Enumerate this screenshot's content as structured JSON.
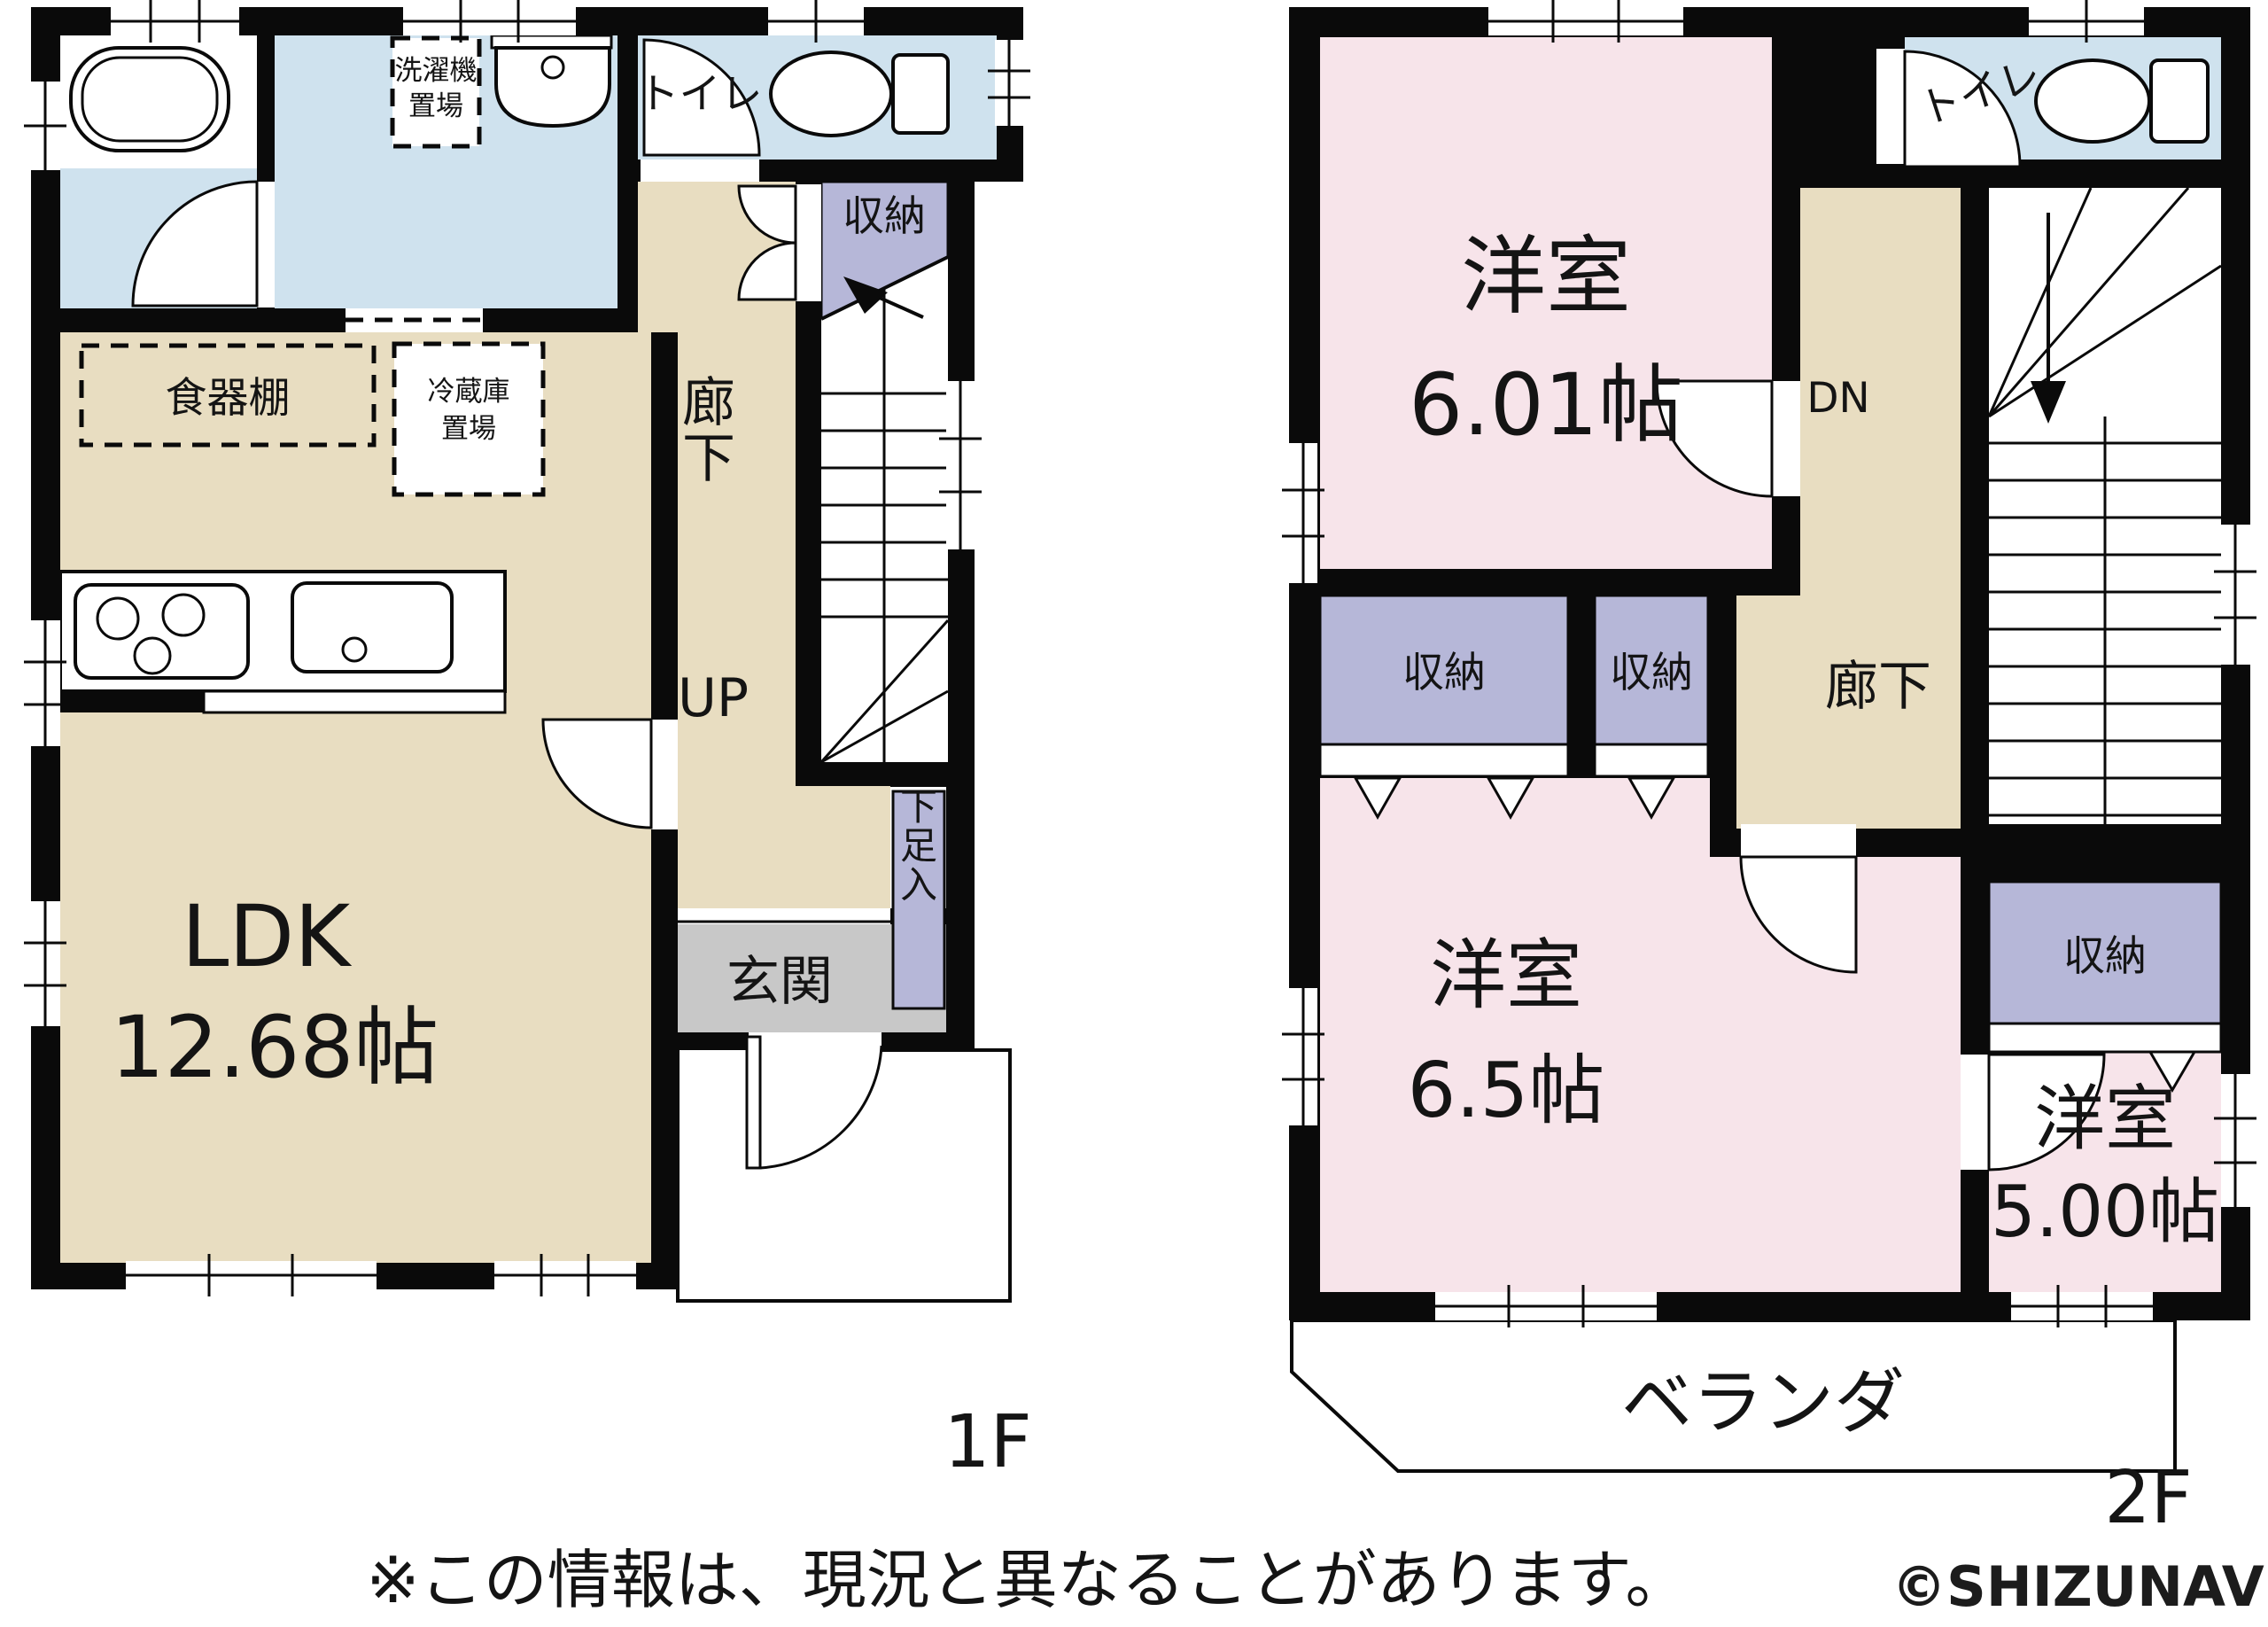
{
  "title": "間取り図",
  "floor1": {
    "floor_label": "1F",
    "ldk": {
      "name": "LDK",
      "size": "12.68帖"
    },
    "hallway": "廊下",
    "up": "UP",
    "entrance": "玄関",
    "shoe_cabinet": "下足入",
    "closet": "収納",
    "toilet": "トイレ",
    "laundry_line1": "洗濯機",
    "laundry_line2": "置場",
    "cupboard": "食器棚",
    "fridge_line1": "冷蔵庫",
    "fridge_line2": "置場"
  },
  "floor2": {
    "floor_label": "2F",
    "room1": {
      "type": "洋室",
      "size": "6.01帖"
    },
    "room2": {
      "type": "洋室",
      "size": "6.5帖"
    },
    "room3": {
      "type": "洋室",
      "size": "5.00帖"
    },
    "toilet": "トイレ",
    "down": "DN",
    "hallway": "廊下",
    "closets": [
      "収納",
      "収納",
      "収納",
      "収納"
    ],
    "veranda": "ベランダ"
  },
  "footer": {
    "note": "※この情報は、現況と異なることがあります。",
    "copyright": "©SHIZUNAVI"
  },
  "colors": {
    "wall": "#0a0a0a",
    "wood_floor": "#e8ddc1",
    "wet_area": "#cfe2ee",
    "bedroom": "#f7e4ea",
    "storage": "#b6b7d8",
    "entrance": "#c8c8c8",
    "background": "#ffffff"
  }
}
